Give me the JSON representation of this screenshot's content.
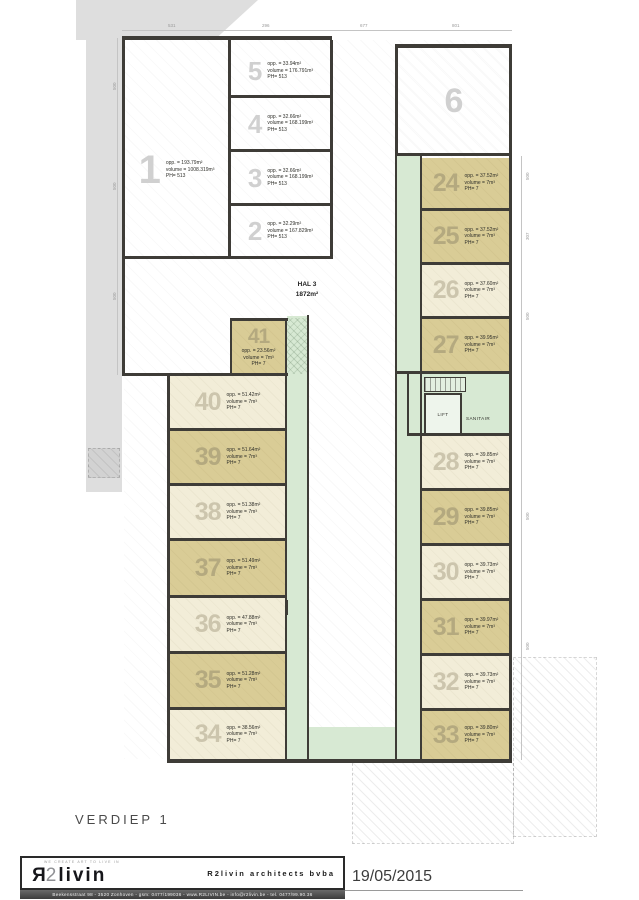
{
  "drawing": {
    "floor_label": "VERDIEP 1",
    "date": "19/05/2015"
  },
  "hall": {
    "name": "HAL 3",
    "area": "1872m²"
  },
  "labels": {
    "lift": "LIFT",
    "sanitair": "SANITAIR"
  },
  "colors": {
    "unit_tan": "#d9cc96",
    "unit_cream": "#f2edd8",
    "corridor_green": "#d7e9d3",
    "wall": "#3e3c37",
    "adjacent_gray": "#dedede"
  },
  "titleblock": {
    "logo_tagline": "WE CREATE ART TO LIVE IN",
    "logo_r": "R",
    "logo_2": "2",
    "logo_rest": "livin",
    "firm": "R2livin architects bvba",
    "address_line": "Beekensstraat 98   -   3520 Zonhoven   -   gsm: 0477/199036   -   www.R2LIVIN.be   -   info@r2livin.be   -   tel. 0477/99.90.36"
  },
  "dims": {
    "top": [
      {
        "t": "531",
        "x": 168
      },
      {
        "t": "296",
        "x": 262
      },
      {
        "t": "677",
        "x": 360
      },
      {
        "t": "801",
        "x": 452
      }
    ],
    "left": [
      {
        "t": "500",
        "y": 90
      },
      {
        "t": "500",
        "y": 190
      },
      {
        "t": "500",
        "y": 300
      }
    ],
    "right": [
      {
        "t": "500",
        "y": 180
      },
      {
        "t": "307",
        "y": 240
      },
      {
        "t": "500",
        "y": 320
      },
      {
        "t": "500",
        "y": 520
      },
      {
        "t": "500",
        "y": 650
      }
    ]
  },
  "plan": {
    "units": [
      {
        "num": "1",
        "x": 125,
        "y": 40,
        "w": 103,
        "h": 216,
        "fill": "white",
        "layout": "inline",
        "numSize": 40,
        "shift": true,
        "lines": [
          "opp. = 193.79m²",
          "volume = 1008.319m³",
          "PH= 513"
        ]
      },
      {
        "num": "5",
        "x": 231,
        "y": 47,
        "w": 99,
        "h": 48,
        "fill": "white",
        "layout": "inline",
        "numSize": 26,
        "lines": [
          "opp. = 33.94m²",
          "volume = 176.791m³",
          "PH= 513"
        ]
      },
      {
        "num": "4",
        "x": 231,
        "y": 98,
        "w": 99,
        "h": 51,
        "fill": "white",
        "layout": "inline",
        "numSize": 26,
        "lines": [
          "opp. = 32.66m²",
          "volume = 168.199m³",
          "PH= 513"
        ]
      },
      {
        "num": "3",
        "x": 231,
        "y": 152,
        "w": 99,
        "h": 51,
        "fill": "white",
        "layout": "inline",
        "numSize": 26,
        "lines": [
          "opp. = 32.66m²",
          "volume = 168.199m³",
          "PH= 513"
        ]
      },
      {
        "num": "2",
        "x": 231,
        "y": 206,
        "w": 99,
        "h": 50,
        "fill": "white",
        "layout": "inline",
        "numSize": 26,
        "lines": [
          "opp. = 32.29m²",
          "volume = 167.829m³",
          "PH= 513"
        ]
      },
      {
        "num": "6",
        "x": 398,
        "y": 48,
        "w": 111,
        "h": 105,
        "fill": "white",
        "layout": "num",
        "numSize": 34,
        "hatch": true,
        "lines": []
      },
      {
        "num": "24",
        "x": 422,
        "y": 158,
        "w": 87,
        "h": 50,
        "fill": "tan",
        "layout": "inline",
        "numSize": 25,
        "lines": [
          "opp. = 37.52m²",
          "volume = 7m³",
          "PH= 7"
        ]
      },
      {
        "num": "25",
        "x": 422,
        "y": 211,
        "w": 87,
        "h": 51,
        "fill": "tan",
        "layout": "inline",
        "numSize": 25,
        "lines": [
          "opp. = 37.52m²",
          "volume = 7m³",
          "PH= 7"
        ]
      },
      {
        "num": "26",
        "x": 422,
        "y": 265,
        "w": 87,
        "h": 51,
        "fill": "cream",
        "layout": "inline",
        "numSize": 25,
        "lines": [
          "opp. = 37.60m²",
          "volume = 7m³",
          "PH= 7"
        ]
      },
      {
        "num": "27",
        "x": 422,
        "y": 319,
        "w": 87,
        "h": 52,
        "fill": "tan",
        "layout": "inline",
        "numSize": 25,
        "lines": [
          "opp. = 39.95m²",
          "volume = 7m³",
          "PH= 7"
        ]
      },
      {
        "num": "28",
        "x": 422,
        "y": 436,
        "w": 87,
        "h": 52,
        "fill": "cream",
        "layout": "inline",
        "numSize": 25,
        "lines": [
          "opp. = 39.85m²",
          "volume = 7m³",
          "PH= 7"
        ]
      },
      {
        "num": "29",
        "x": 422,
        "y": 491,
        "w": 87,
        "h": 52,
        "fill": "tan",
        "layout": "inline",
        "numSize": 25,
        "lines": [
          "opp. = 39.85m²",
          "volume = 7m³",
          "PH= 7"
        ]
      },
      {
        "num": "30",
        "x": 422,
        "y": 546,
        "w": 87,
        "h": 52,
        "fill": "cream",
        "layout": "inline",
        "numSize": 25,
        "lines": [
          "opp. = 39.73m²",
          "volume = 7m³",
          "PH= 7"
        ]
      },
      {
        "num": "31",
        "x": 422,
        "y": 601,
        "w": 87,
        "h": 52,
        "fill": "tan",
        "layout": "inline",
        "numSize": 25,
        "lines": [
          "opp. = 39.97m²",
          "volume = 7m³",
          "PH= 7"
        ]
      },
      {
        "num": "32",
        "x": 422,
        "y": 656,
        "w": 87,
        "h": 52,
        "fill": "cream",
        "layout": "inline",
        "numSize": 25,
        "lines": [
          "opp. = 39.73m²",
          "volume = 7m³",
          "PH= 7"
        ]
      },
      {
        "num": "33",
        "x": 422,
        "y": 711,
        "w": 87,
        "h": 48,
        "fill": "tan",
        "layout": "inline",
        "numSize": 25,
        "lines": [
          "opp. = 39.80m²",
          "volume = 7m³",
          "PH= 7"
        ]
      },
      {
        "num": "41",
        "x": 232,
        "y": 321,
        "w": 53,
        "h": 52,
        "fill": "tan",
        "layout": "stack",
        "numSize": 21,
        "lines": [
          "opp. = 23.56m²",
          "volume = 7m³",
          "PH= 7"
        ]
      },
      {
        "num": "40",
        "x": 170,
        "y": 376,
        "w": 115,
        "h": 52,
        "fill": "cream",
        "layout": "inline",
        "numSize": 25,
        "lines": [
          "opp. = 51.42m²",
          "volume = 7m³",
          "PH= 7"
        ]
      },
      {
        "num": "39",
        "x": 170,
        "y": 431,
        "w": 115,
        "h": 52,
        "fill": "tan",
        "layout": "inline",
        "numSize": 25,
        "lines": [
          "opp. = 51.64m²",
          "volume = 7m³",
          "PH= 7"
        ]
      },
      {
        "num": "38",
        "x": 170,
        "y": 486,
        "w": 115,
        "h": 52,
        "fill": "cream",
        "layout": "inline",
        "numSize": 25,
        "lines": [
          "opp. = 51.38m²",
          "volume = 7m³",
          "PH= 7"
        ]
      },
      {
        "num": "37",
        "x": 170,
        "y": 541,
        "w": 115,
        "h": 54,
        "fill": "tan",
        "layout": "inline",
        "numSize": 25,
        "lines": [
          "opp. = 51.49m²",
          "volume = 7m³",
          "PH= 7"
        ]
      },
      {
        "num": "36",
        "x": 170,
        "y": 598,
        "w": 115,
        "h": 53,
        "fill": "cream",
        "layout": "inline",
        "numSize": 25,
        "lines": [
          "opp. = 47.88m²",
          "volume = 7m³",
          "PH= 7"
        ]
      },
      {
        "num": "35",
        "x": 170,
        "y": 654,
        "w": 115,
        "h": 53,
        "fill": "tan",
        "layout": "inline",
        "numSize": 25,
        "lines": [
          "opp. = 51.28m²",
          "volume = 7m³",
          "PH= 7"
        ]
      },
      {
        "num": "34",
        "x": 170,
        "y": 710,
        "w": 115,
        "h": 49,
        "fill": "cream",
        "layout": "inline",
        "numSize": 25,
        "lines": [
          "opp. = 38.56m²",
          "volume = 7m³",
          "PH= 7"
        ]
      }
    ]
  }
}
